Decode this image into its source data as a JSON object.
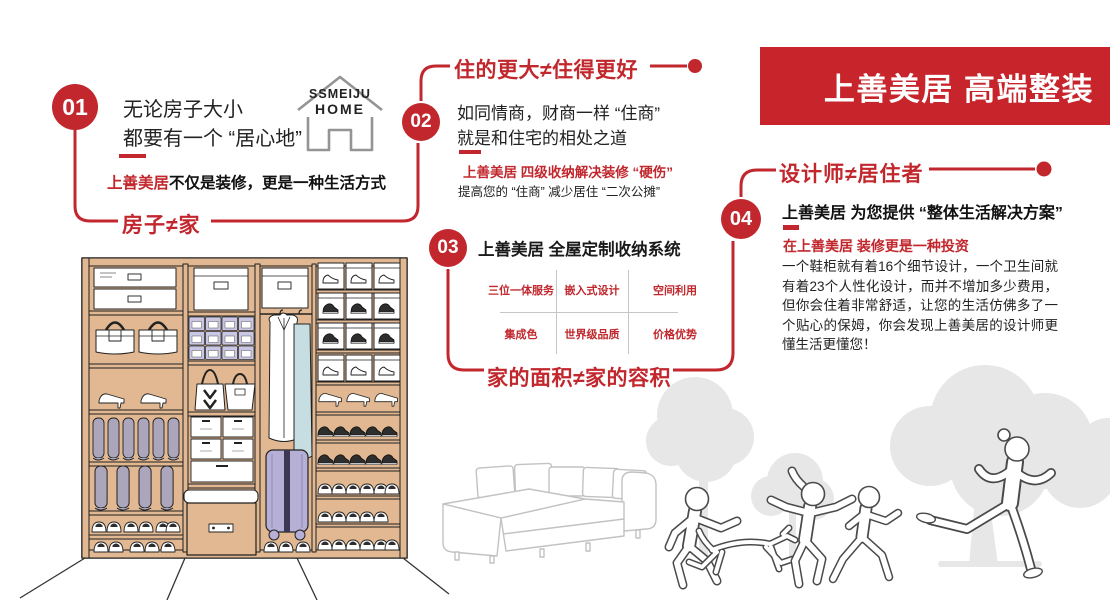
{
  "banner": {
    "title": "上善美居 高端整装"
  },
  "logo": {
    "line1": "SSMEIJU",
    "line2": "HOME"
  },
  "sections": {
    "s1": {
      "num": "01",
      "body_line1": "无论房子大小",
      "body_line2": "都要有一个 “居心地”",
      "highlight_red": "上善美居",
      "highlight_rest": "不仅是装修，更是一种生活方式",
      "slogan": "房子≠家"
    },
    "s2": {
      "num": "02",
      "slogan": "住的更大≠住得更好",
      "body_line1": "如同情商，财商一样 “住商”",
      "body_line2": "就是和住宅的相处之道",
      "sub_red": "上善美居 四级收纳解决装修 “硬伤”",
      "sub_black": "提高您的 “住商” 减少居住 “二次公摊”"
    },
    "s3": {
      "num": "03",
      "title": "上善美居 全屋定制收纳系统",
      "grid": [
        "三位一体服务",
        "嵌入式设计",
        "空间利用",
        "集成色",
        "世界级品质",
        "价格优势"
      ],
      "slogan": "家的面积≠家的容积"
    },
    "s4": {
      "num": "04",
      "slogan": "设计师≠居住者",
      "headline": "上善美居 为您提供 “整体生活解决方案”",
      "sub_red": "在上善美居 装修更是一种投资",
      "body": "一个鞋柜就有着16个细节设计，一个卫生间就有着23个人性化设计，而并不增加多少费用，但你会住着非常舒适，让您的生活仿佛多了一个贴心的保姆，你会发现上善美居的设计师更懂生活更懂您！"
    }
  },
  "colors": {
    "accent_red": "#c1272d",
    "banner_bg": "#c7242b",
    "wardrobe_wood": "#e2b892",
    "storage_bin": "#c9c7e4",
    "suitcase": "#b6b0d6",
    "garment_teal": "#c6dee1",
    "tree_gray": "#e7e7e7",
    "figure_outline": "#4a4a4a",
    "sofa_line": "#c2c2c2"
  }
}
